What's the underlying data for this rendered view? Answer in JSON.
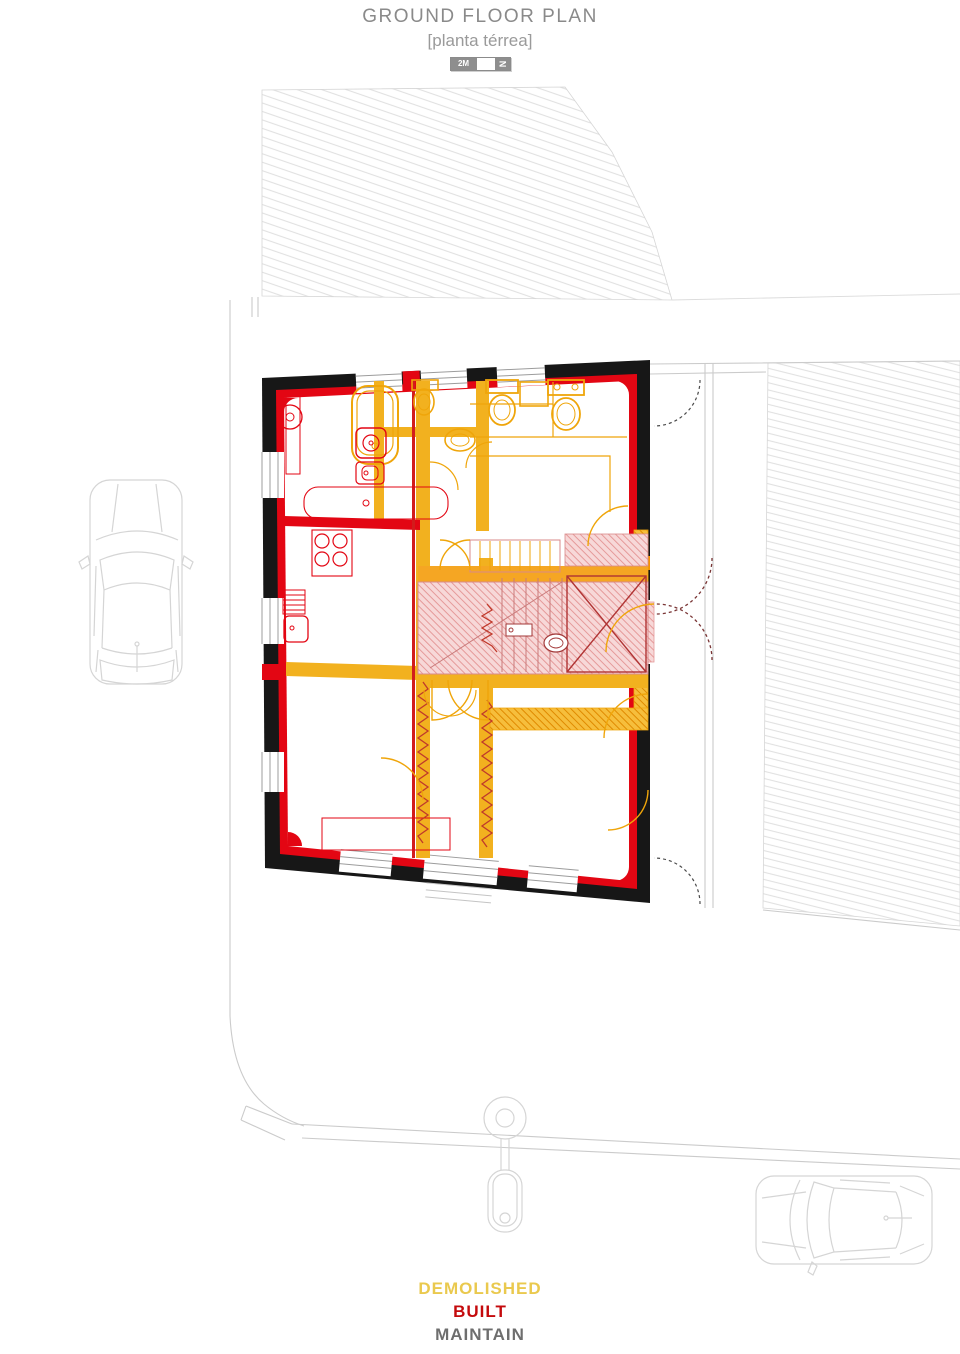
{
  "title": "GROUND FLOOR PLAN",
  "subtitle": "[planta térrea]",
  "scale_bar": {
    "distance_label": "2M",
    "north_label": "N"
  },
  "legend": {
    "items": [
      {
        "label": "DEMOLISHED",
        "color": "#EAC94E"
      },
      {
        "label": "BUILT",
        "color": "#C40A0C"
      },
      {
        "label": "MAINTAIN",
        "color": "#6E6E6E"
      }
    ]
  },
  "colors": {
    "demolished": "#F2B11F",
    "demolished_line": "#EFA50A",
    "demolished_orange": "#F59300",
    "built": "#E30613",
    "maintain_wall": "#171717",
    "pink_fill": "#F7D8D8",
    "pink_line": "#E59A9A",
    "site_line": "#CBCBCB",
    "hatch_line": "#E1E1E1",
    "window_frame": "#9C9C9C",
    "title_text": "#8A8A8A"
  }
}
